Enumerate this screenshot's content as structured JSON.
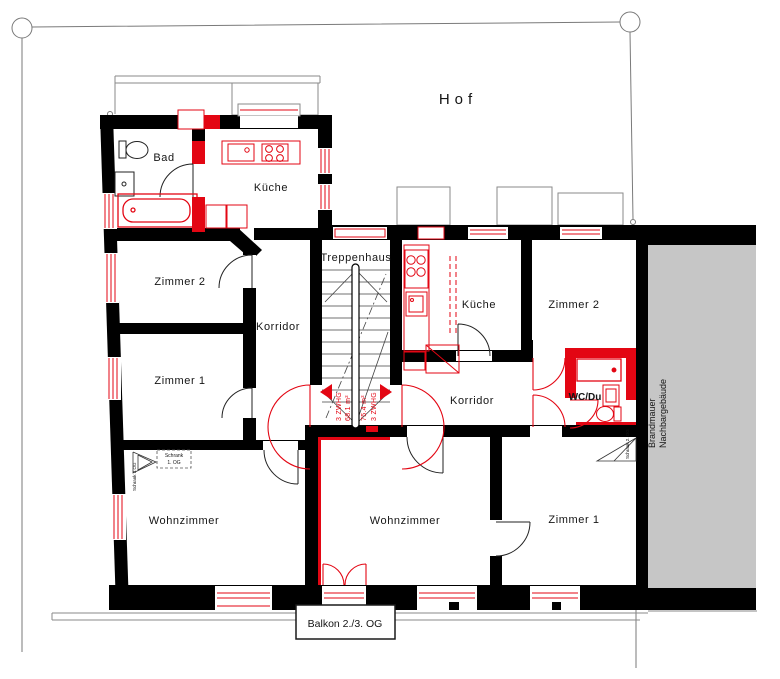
{
  "colors": {
    "wall_black": "#000000",
    "accent_red": "#e30613",
    "neighbor_gray": "#c6c6c6",
    "survey_gray": "#7a7a7a",
    "text_dark": "#151515"
  },
  "site": {
    "courtyard": "Hof",
    "balcony": "Balkon 2./3. OG",
    "firewall_line1": "Brandmauer",
    "firewall_line2": "Nachbargebäude"
  },
  "stairwell": {
    "label": "Treppenhaus"
  },
  "apartment_left": {
    "type_tag": "3 ZWHG",
    "area_tag": "68.1 m²",
    "rooms": {
      "bad": "Bad",
      "kueche": "Küche",
      "zimmer2": "Zimmer 2",
      "zimmer1": "Zimmer 1",
      "korridor": "Korridor",
      "wohnzimmer": "Wohnzimmer"
    },
    "annotations": {
      "schrank_1og_line1": "Schrank",
      "schrank_1og_line2": "1. OG",
      "schrank_3og": "Schrank 3.OG"
    }
  },
  "apartment_right": {
    "type_tag": "3 ZWHG",
    "area_tag": "75.4 m²",
    "rooms": {
      "kueche": "Küche",
      "zimmer2": "Zimmer 2",
      "zimmer1": "Zimmer 1",
      "korridor": "Korridor",
      "wc_du": "WC/Du",
      "wohnzimmer": "Wohnzimmer"
    },
    "annotations": {
      "schrank_2og": "Schrank 2. OG"
    }
  }
}
